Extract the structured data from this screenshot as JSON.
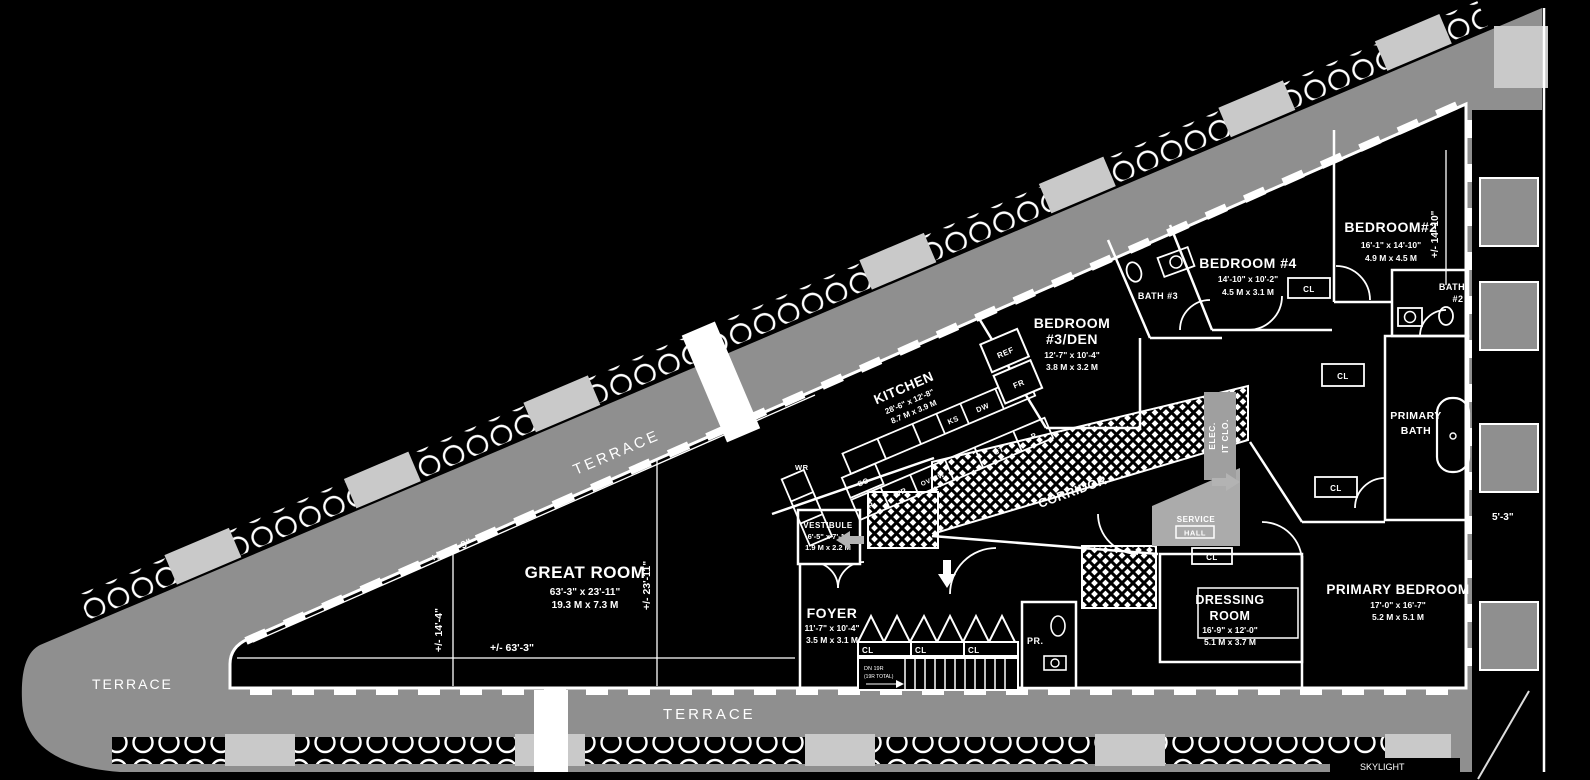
{
  "colors": {
    "background": "#000000",
    "walls": "#ffffff",
    "terrace_gray": "#8f8f8f",
    "planter_gray": "#c9c9c9",
    "service_gray": "#ababab",
    "arrow_gray": "#b3b3b3"
  },
  "labels": {
    "terrace_top": "TERRACE",
    "terrace_left": "TERRACE",
    "terrace_bottom": "TERRACE",
    "skylight": "SKYLIGHT",
    "corridor": "CORRIDOR"
  },
  "rooms": {
    "great_room": {
      "name": "GREAT ROOM",
      "ft": "63'-3\" x 23'-11\"",
      "m": "19.3 M x 7.3 M"
    },
    "kitchen": {
      "name": "KITCHEN",
      "ft": "28'-6\" x 12'-8\"",
      "m": "8.7 M x 3.9 M"
    },
    "bedroom3": {
      "name": "BEDROOM",
      "name2": "#3/DEN",
      "ft": "12'-7\" x 10'-4\"",
      "m": "3.8 M x 3.2 M"
    },
    "bedroom4": {
      "name": "BEDROOM #4",
      "ft": "14'-10\" x 10'-2\"",
      "m": "4.5 M x 3.1 M"
    },
    "bedroom2": {
      "name": "BEDROOM#2",
      "ft": "16'-1\" x 14'-10\"",
      "m": "4.9 M x 4.5 M"
    },
    "primary_bedroom": {
      "name": "PRIMARY BEDROOM",
      "ft": "17'-0\" x 16'-7\"",
      "m": "5.2 M x 5.1 M"
    },
    "dressing_room": {
      "name": "DRESSING",
      "name2": "ROOM",
      "ft": "16'-9\" x 12'-0\"",
      "m": "5.1 M x 3.7 M"
    },
    "foyer": {
      "name": "FOYER",
      "ft": "11'-7\" x 10'-4\"",
      "m": "3.5 M x 3.1 M"
    },
    "vestibule": {
      "name": "VESTIBULE",
      "ft": "6'-5\" x 7'-1\"",
      "m": "1.9 M x 2.2 M"
    },
    "bath3": {
      "name": "BATH #3"
    },
    "bath2": {
      "name": "BATH",
      "name2": "#2"
    },
    "primary_bath": {
      "name": "PRIMARY",
      "name2": "BATH"
    },
    "service_hall": {
      "name": "SERVICE",
      "name2": "HALL"
    },
    "elec_closet": {
      "name": "ELEC.",
      "name2": "IT CLO."
    },
    "powder_room": {
      "name": "PR."
    }
  },
  "fixtures": {
    "cl": "CL",
    "wr": "WR",
    "so": "SO",
    "ks": "KS",
    "dw": "DW",
    "p": "P",
    "ov_mw": "OV/MW",
    "ct": "CT",
    "ref": "REF",
    "fr": "FR"
  },
  "stairs": {
    "note1": "DN 19R",
    "note2": "(19R TOTAL)"
  },
  "dimensions": {
    "great_w": "+/- 63'-3\"",
    "great_h": "+/- 23'-11\"",
    "wall_diag": "+/- 64'-9\"",
    "tip_h": "+/- 14'-4\"",
    "bedroom2_h": "+/- 14'-10\"",
    "terrace_gap_top": "4'-5\"",
    "terrace_gap_bottom": "4'-5\"",
    "right_gap": "5'-3\""
  }
}
